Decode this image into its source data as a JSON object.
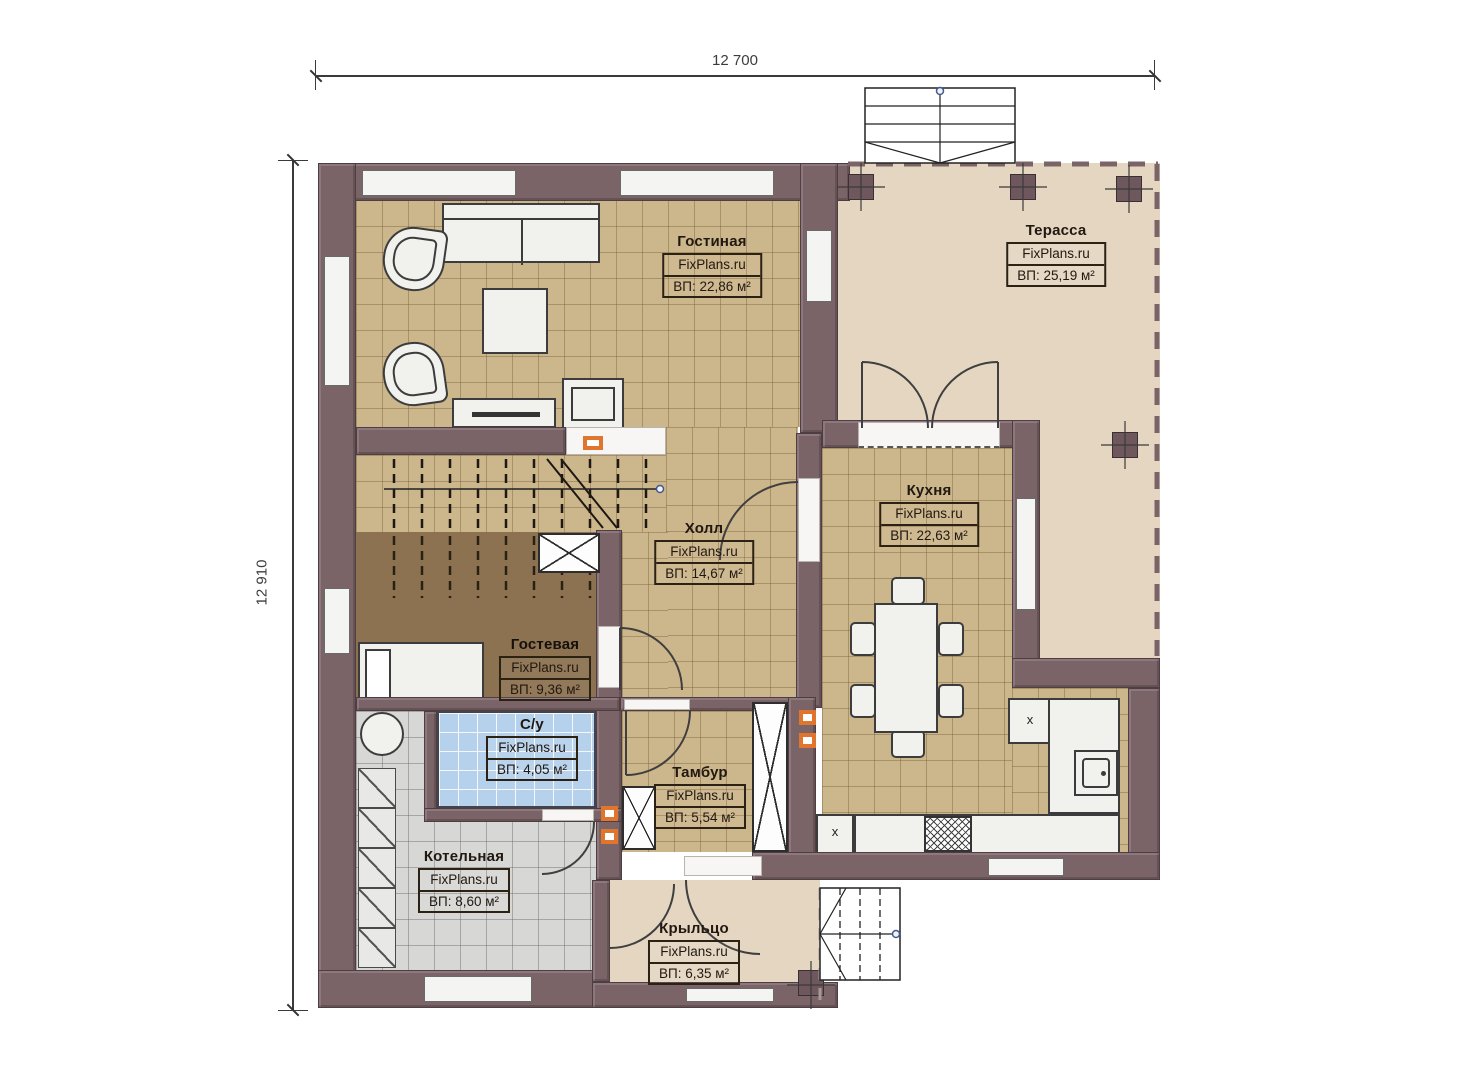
{
  "watermark": "FixPlans.ru",
  "dimensions": {
    "width_label": "12 700",
    "height_label": "12 910"
  },
  "rooms": [
    {
      "name": "Гостиная",
      "area": "ВП: 22,86 м²"
    },
    {
      "name": "Терасса",
      "area": "ВП: 25,19 м²"
    },
    {
      "name": "Кухня",
      "area": "ВП: 22,63 м²"
    },
    {
      "name": "Холл",
      "area": "ВП: 14,67 м²"
    },
    {
      "name": "Гостевая",
      "area": "ВП: 9,36 м²"
    },
    {
      "name": "С/у",
      "area": "ВП: 4,05 м²"
    },
    {
      "name": "Тамбур",
      "area": "ВП: 5,54 м²"
    },
    {
      "name": "Котельная",
      "area": "ВП: 8,60 м²"
    },
    {
      "name": "Крыльцо",
      "area": "ВП: 6,35 м²"
    }
  ],
  "markers": {
    "counter_mark": "x"
  },
  "colors": {
    "wall": "#7b6468",
    "floor_tan": "#ccb68c",
    "floor_beige": "#e4d6c1",
    "floor_brown": "#8d7251",
    "floor_blue": "#b6d1eb",
    "floor_gray": "#d7d7d5",
    "accent_orange": "#e0762e"
  }
}
